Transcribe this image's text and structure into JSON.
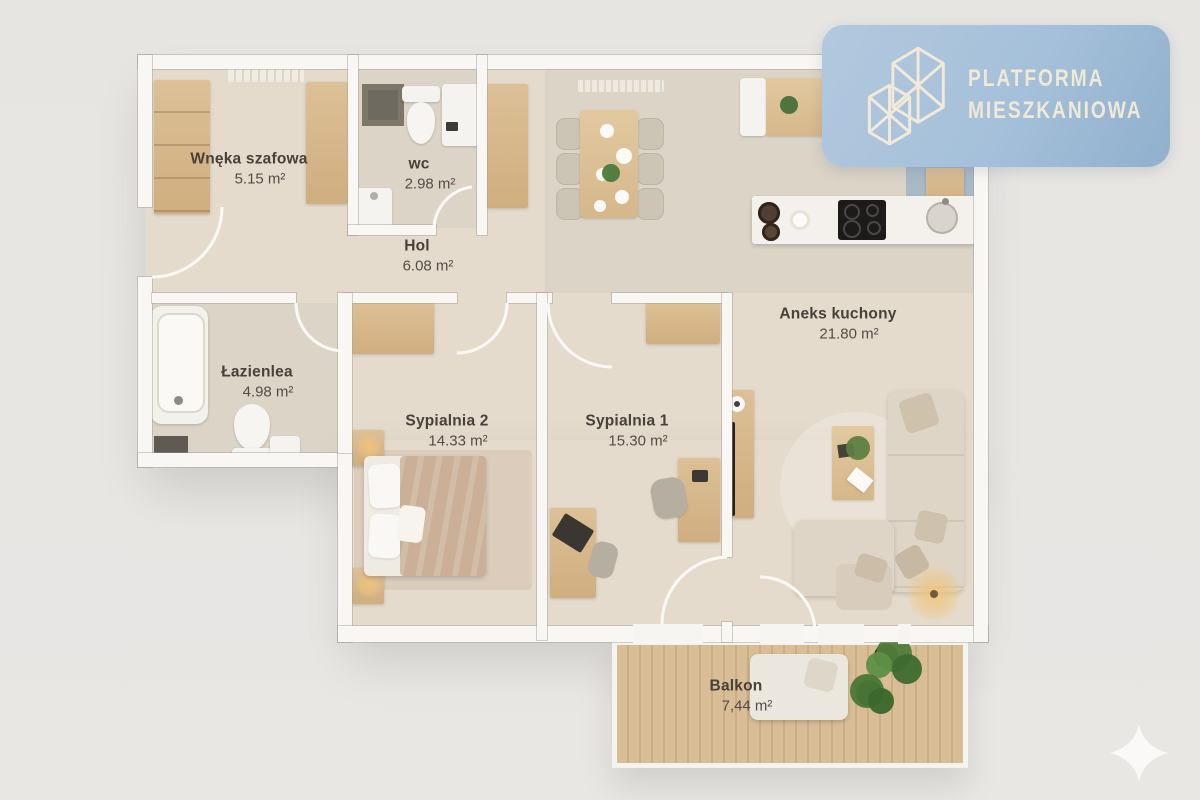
{
  "page": {
    "background": "#e8e6e3"
  },
  "logo": {
    "line1": "PLATFORMA",
    "line2": "MIESZKANIOWA",
    "background": "#a5c0da",
    "text_color": "#f1e8d6",
    "icon": "building-lattice-icon"
  },
  "rooms": [
    {
      "name": "Wnęka szafowa",
      "area": "5.15 m²"
    },
    {
      "name": "wc",
      "area": "2.98 m²"
    },
    {
      "name": "Hol",
      "area": "6.08 m²"
    },
    {
      "name": "Łazienlea",
      "area": "4.98 m²"
    },
    {
      "name": "Sypialnia 2",
      "area": "14.33 m²"
    },
    {
      "name": "Sypialnia 1",
      "area": "15.30 m²"
    },
    {
      "name": "Aneks kuchony",
      "area": "21.80 m²"
    },
    {
      "name": "Balkon",
      "area": "7,44 m²"
    }
  ],
  "colors": {
    "floor": "#e5dbcd",
    "wall": "#f8f7f4",
    "wood": "#d5b88c",
    "badge_blue": "#a5c0da",
    "deck": "#d4b791",
    "label_text": "#47413a"
  },
  "watermark": {
    "icon": "sparkle-icon"
  }
}
